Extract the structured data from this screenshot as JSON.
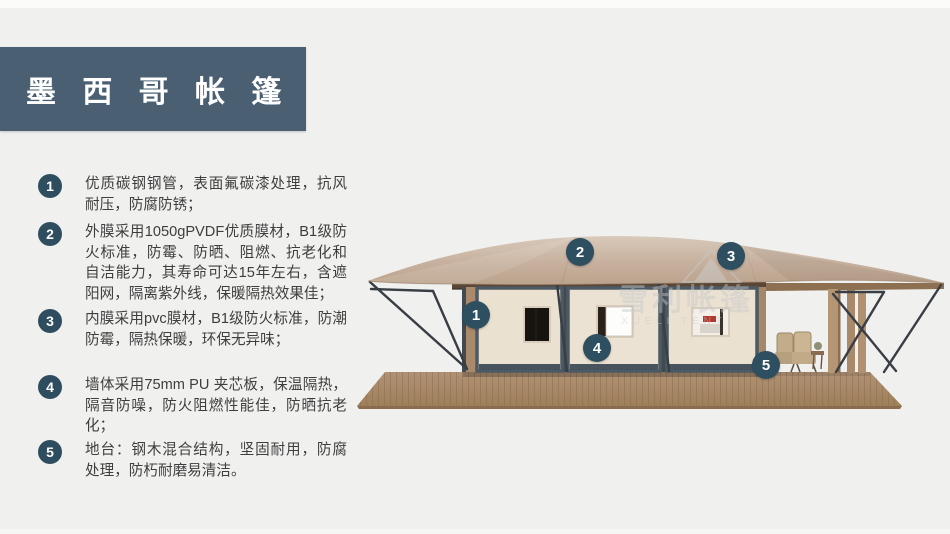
{
  "slide": {
    "title": "墨 西 哥 帐 篷",
    "features": [
      {
        "num": "1",
        "text": "优质碳钢钢管，表面氟碳漆处理，抗风耐压，防腐防锈；"
      },
      {
        "num": "2",
        "text": "外膜采用1050gPVDF优质膜材，B1级防火标准，防霉、防晒、阻燃、抗老化和自洁能力，其寿命可达15年左右，含遮阳网，隔离紫外线，保暖隔热效果佳；"
      },
      {
        "num": "3",
        "text": "内膜采用pvc膜材，B1级防火标准，防潮防霉，隔热保暖，环保无异味；"
      },
      {
        "num": "4",
        "text": "墙体采用75mm PU 夹芯板，保温隔热，隔音防噪，防火阻燃性能佳，防晒抗老化；"
      },
      {
        "num": "5",
        "text": "地台：钢木混合结构，坚固耐用，防腐处理，防朽耐磨易清洁。"
      }
    ],
    "callouts": [
      {
        "num": "1"
      },
      {
        "num": "2"
      },
      {
        "num": "3"
      },
      {
        "num": "4"
      },
      {
        "num": "5"
      }
    ],
    "watermark": {
      "cn": "雪利帐篷",
      "en": "XUELI TENT"
    },
    "colors": {
      "accent": "#2e4d5e",
      "title_bar": "#4a6072",
      "background": "#f0f0ef",
      "roof": "#c7b19e",
      "wall": "#ece2d3",
      "frame": "#4d5963",
      "deck": "#a8896a"
    }
  }
}
